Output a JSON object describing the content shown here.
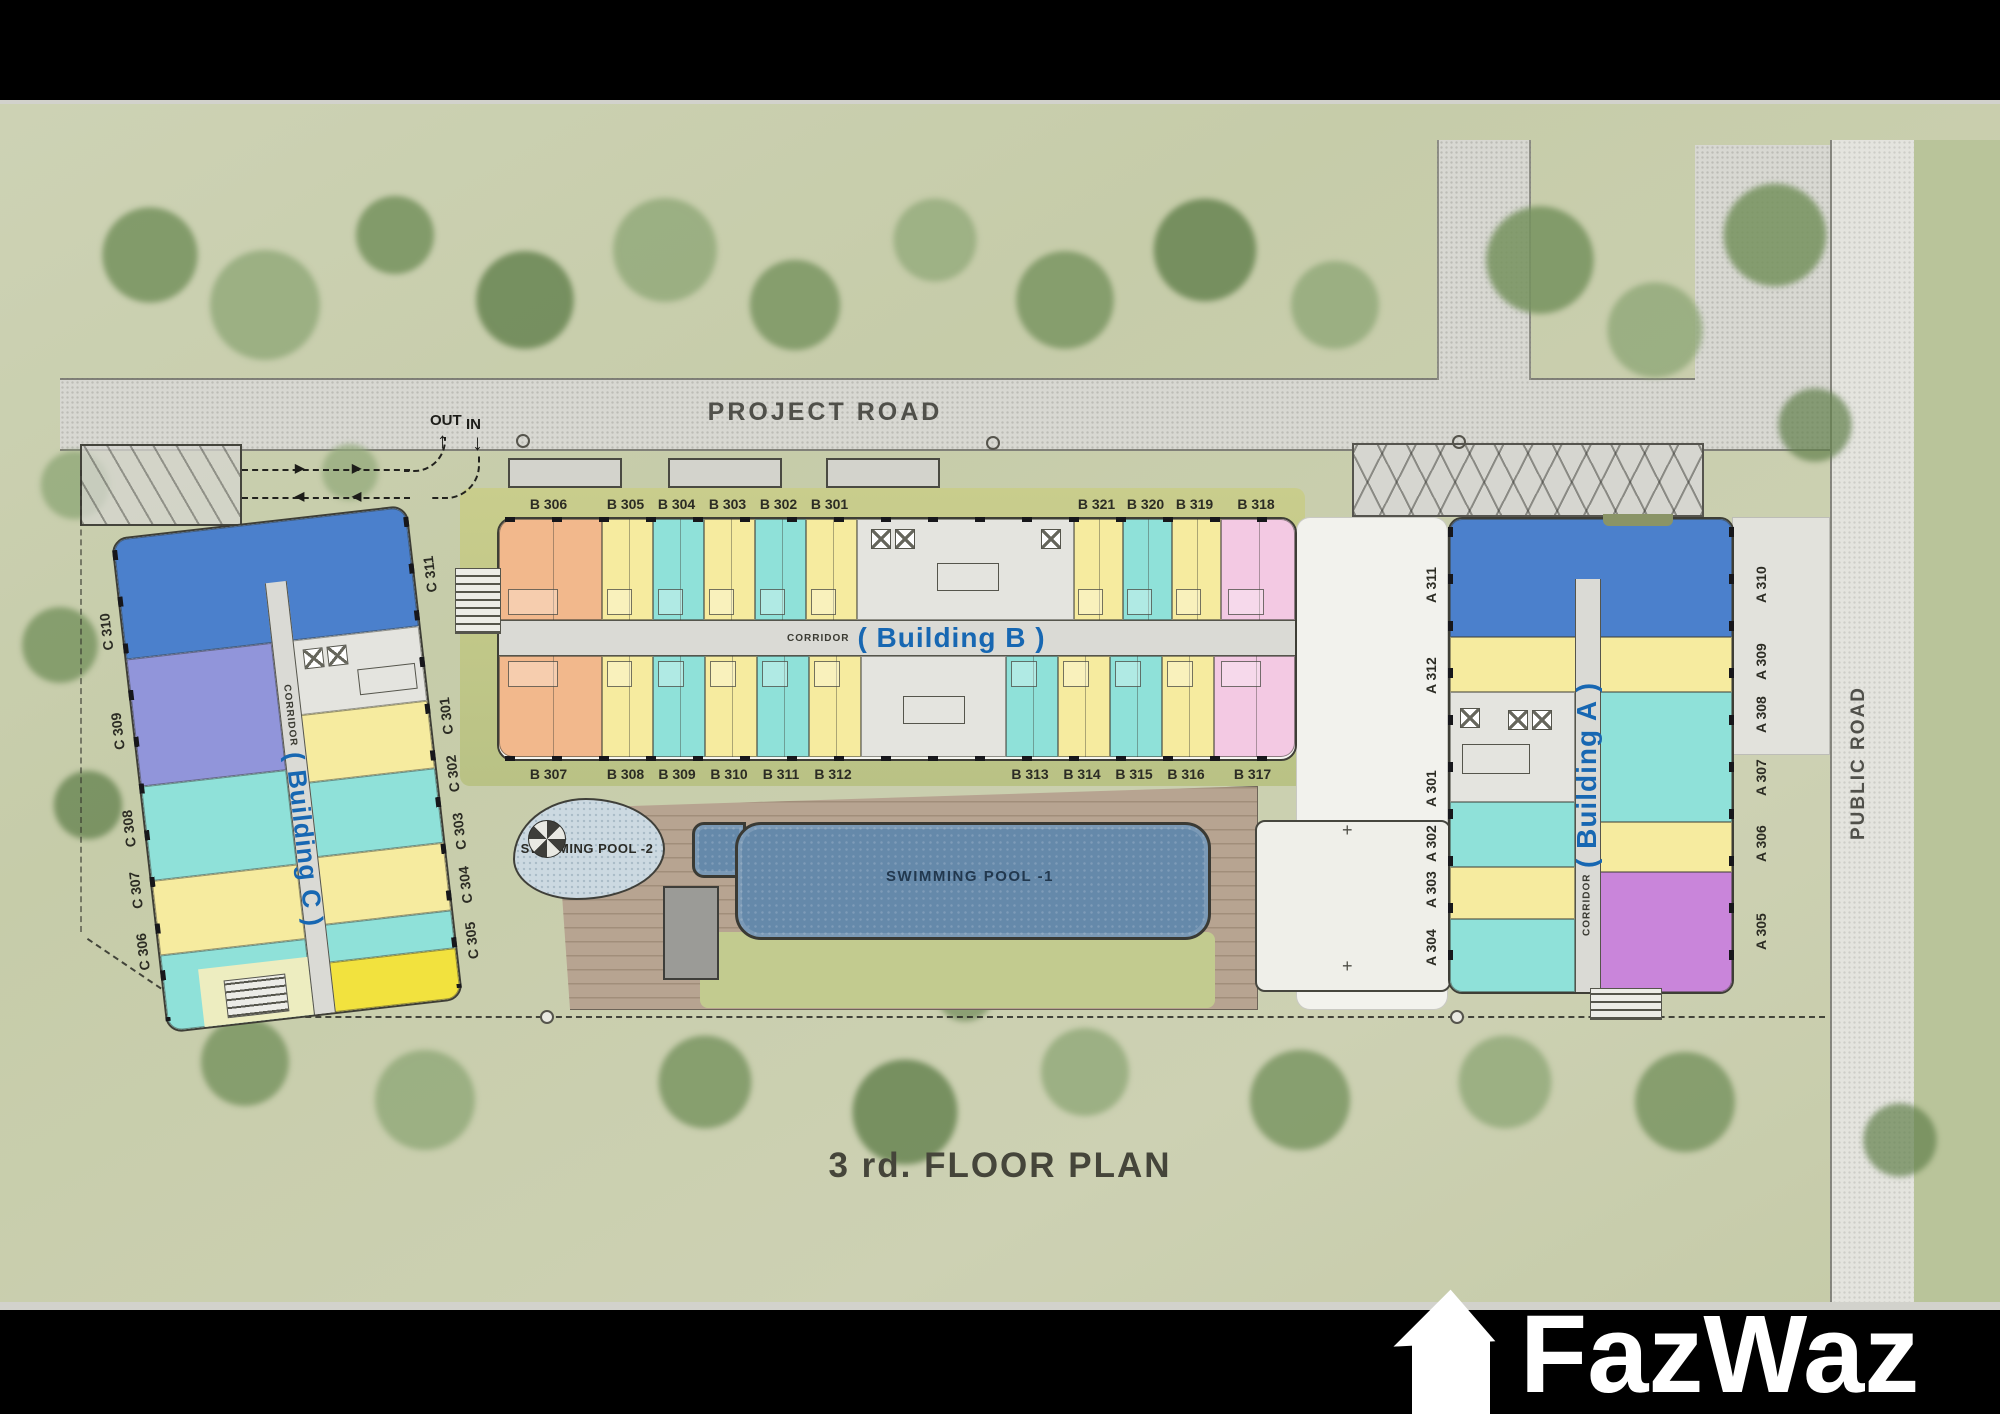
{
  "title": "3 rd. FLOOR PLAN",
  "watermark": "FazWaz",
  "roads": {
    "project_road": "PROJECT ROAD",
    "public_road": "PUBLIC ROAD"
  },
  "traffic": {
    "out_label": "OUT",
    "in_label": "IN"
  },
  "pools": [
    {
      "name": "SWIMMING POOL  -2"
    },
    {
      "name": "SWIMMING POOL  -1"
    }
  ],
  "buildings": {
    "b": {
      "corridor": "CORRIDOR",
      "name": "( Building B )",
      "top_units": [
        {
          "label": "B 306",
          "color": "orange"
        },
        {
          "label": "B 305",
          "color": "yellow"
        },
        {
          "label": "B 304",
          "color": "cyan"
        },
        {
          "label": "B 303",
          "color": "yellow"
        },
        {
          "label": "B 302",
          "color": "cyan"
        },
        {
          "label": "B 301",
          "color": "yellow"
        },
        {
          "label": "",
          "color": "core"
        },
        {
          "label": "B 321",
          "color": "yellow"
        },
        {
          "label": "B 320",
          "color": "cyan"
        },
        {
          "label": "B 319",
          "color": "yellow"
        },
        {
          "label": "B 318",
          "color": "pink"
        }
      ],
      "bottom_units": [
        {
          "label": "B 307",
          "color": "orange"
        },
        {
          "label": "B 308",
          "color": "yellow"
        },
        {
          "label": "B 309",
          "color": "cyan"
        },
        {
          "label": "B 310",
          "color": "yellow"
        },
        {
          "label": "B 311",
          "color": "cyan"
        },
        {
          "label": "B 312",
          "color": "yellow"
        },
        {
          "label": "",
          "color": "core"
        },
        {
          "label": "B 313",
          "color": "cyan"
        },
        {
          "label": "B 314",
          "color": "yellow"
        },
        {
          "label": "B 315",
          "color": "cyan"
        },
        {
          "label": "B 316",
          "color": "yellow"
        },
        {
          "label": "B 317",
          "color": "pink"
        }
      ]
    },
    "a": {
      "corridor": "CORRIDOR",
      "name": "( Building A )",
      "left_labels": [
        "A 311",
        "A 312",
        "A 301",
        "A 302",
        "A 303",
        "A 304"
      ],
      "right_labels": [
        "A 310",
        "A 309",
        "A 308",
        "A 307",
        "A 306",
        "A 305"
      ]
    },
    "c": {
      "corridor": "CORRIDOR",
      "name": "( Building C )",
      "left_labels": [
        "C 310",
        "C 309",
        "C 308",
        "C 307",
        "C 306"
      ],
      "right_labels": [
        "C 311",
        "C 301",
        "C 302",
        "C 303",
        "C 304",
        "C 305"
      ]
    }
  },
  "colors": {
    "background_sage": "#c8cdae",
    "tree_green": "#7d9866",
    "road_gray": "#d8d8d2",
    "unit_orange": "#f2b88c",
    "unit_yellow": "#f6eb9f",
    "unit_cyan": "#8fe1d9",
    "unit_pink": "#f3c9e3",
    "unit_blue": "#4b80cc",
    "unit_periwinkle": "#9195da",
    "unit_purple": "#c985da",
    "unit_bright_yellow": "#f2e23e",
    "corridor_text_blue": "#1767b2",
    "pool_deep": "#6589aa",
    "pool_shallow": "#c8d6de",
    "deck_wood": "#b7a491"
  }
}
